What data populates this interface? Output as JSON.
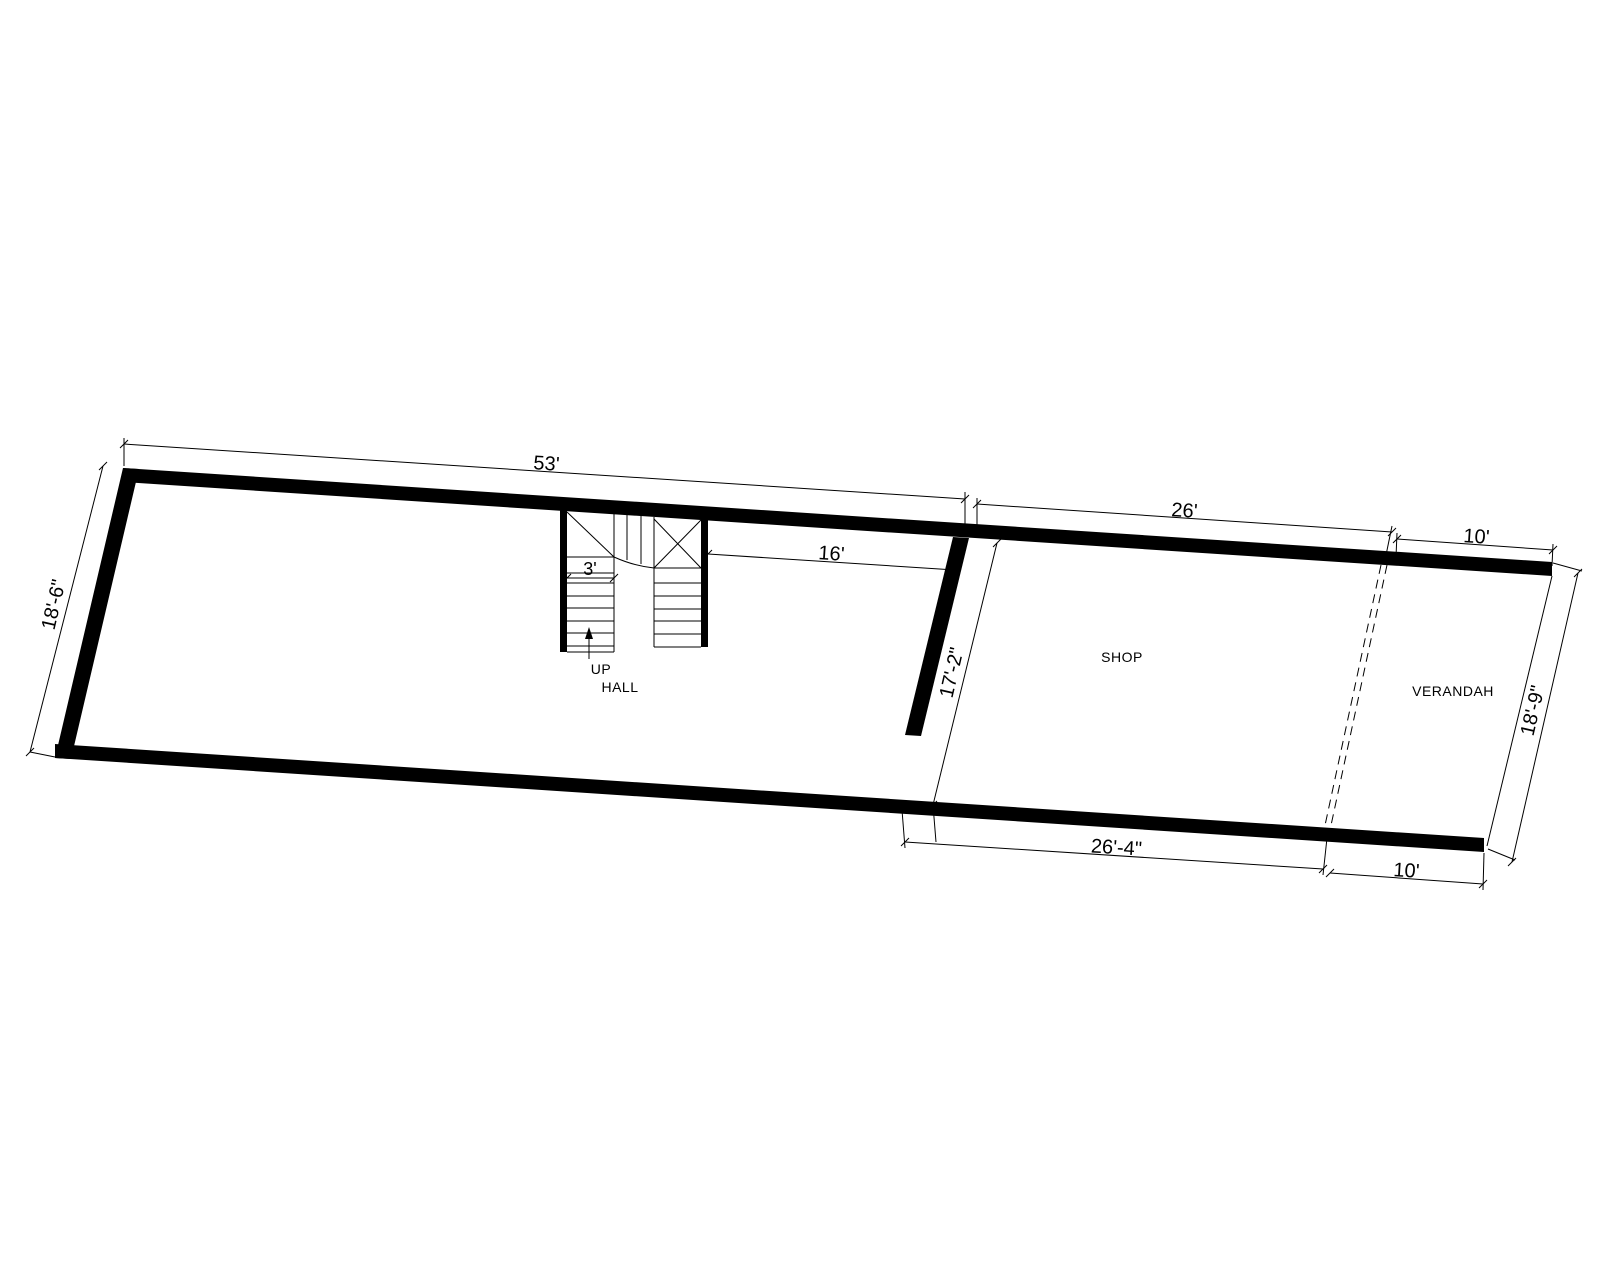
{
  "page": {
    "background": "#ffffff",
    "line_color": "#000000"
  },
  "rooms": {
    "hall_label": "HALL",
    "shop_label": "SHOP",
    "verandah_label": "VERANDAH"
  },
  "stair": {
    "up_label": "UP",
    "flight_width_dim": "3'"
  },
  "dimensions": {
    "hall_length_top": "53'",
    "hall_height_left": "18'-6\"",
    "shop_length_top": "26'",
    "verandah_length_top": "10'",
    "stair_to_partition": "16'",
    "shop_height_left": "17'-2\"",
    "shop_length_bottom": "26'-4\"",
    "verandah_length_bottom": "10'",
    "verandah_height_right": "18'-9\""
  }
}
